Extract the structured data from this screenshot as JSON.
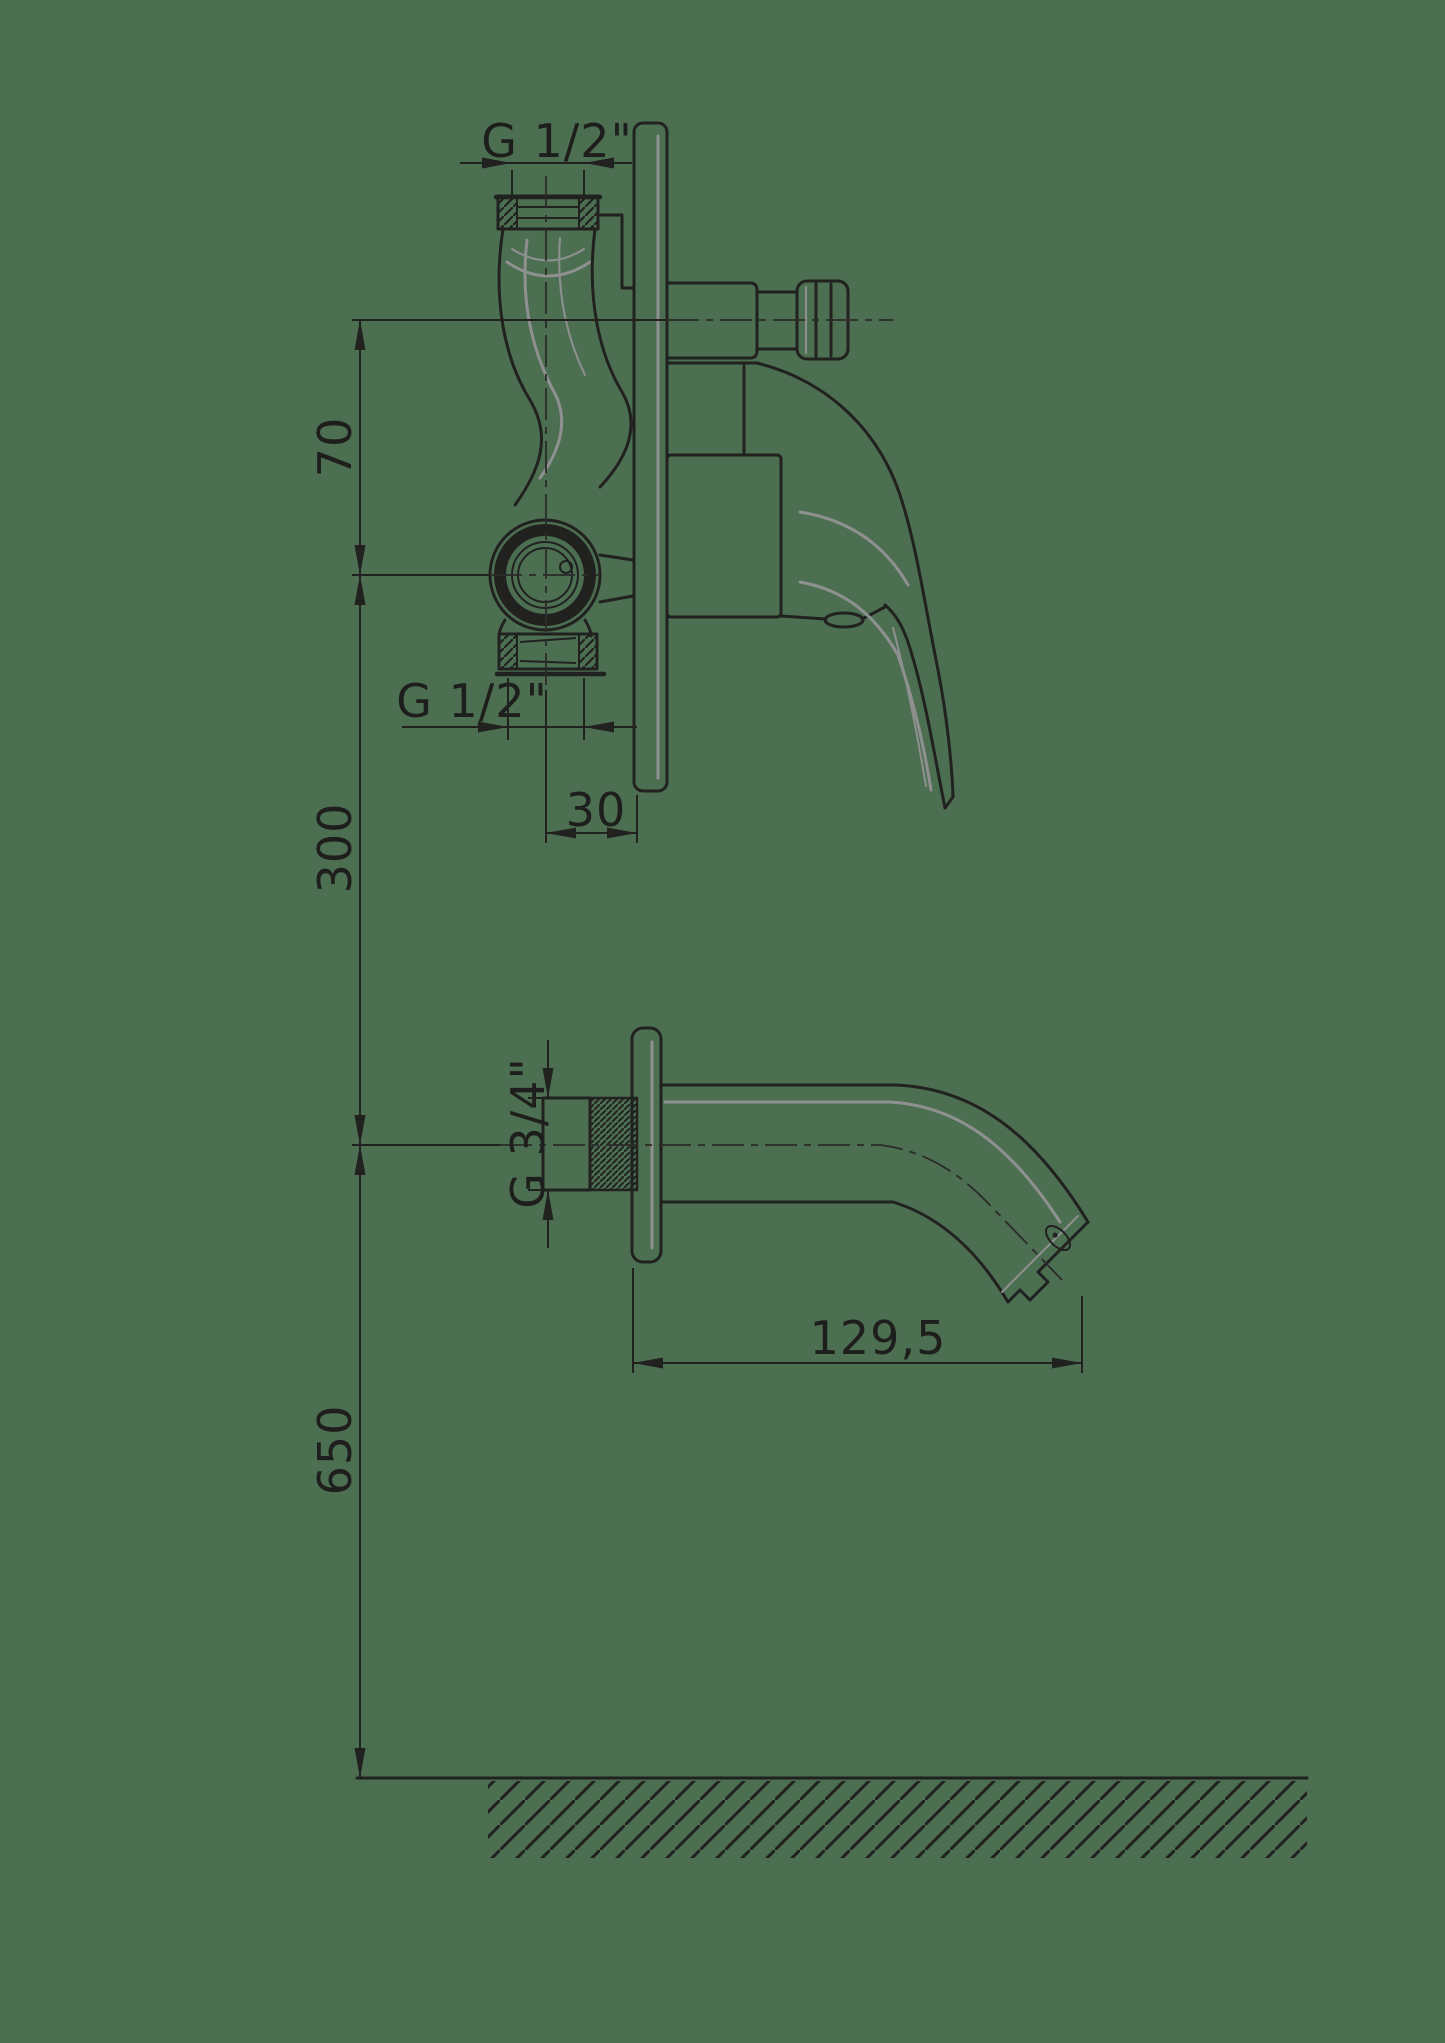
{
  "drawing": {
    "title": "Wall-mounted bath mixer installation drawing",
    "labels": {
      "top_thread": "G 1/2\"",
      "bottom_thread": "G 1/2\"",
      "spout_thread": "G 3/4\"",
      "outlet_to_valve_offset": "70",
      "valve_to_spout_drop": "300",
      "spout_to_floor_height": "650",
      "plate_projection": "30",
      "spout_reach": "129,5"
    },
    "colors": {
      "background": "#4C6F52",
      "line": "#21211F",
      "highlight": "#8F9191"
    }
  }
}
